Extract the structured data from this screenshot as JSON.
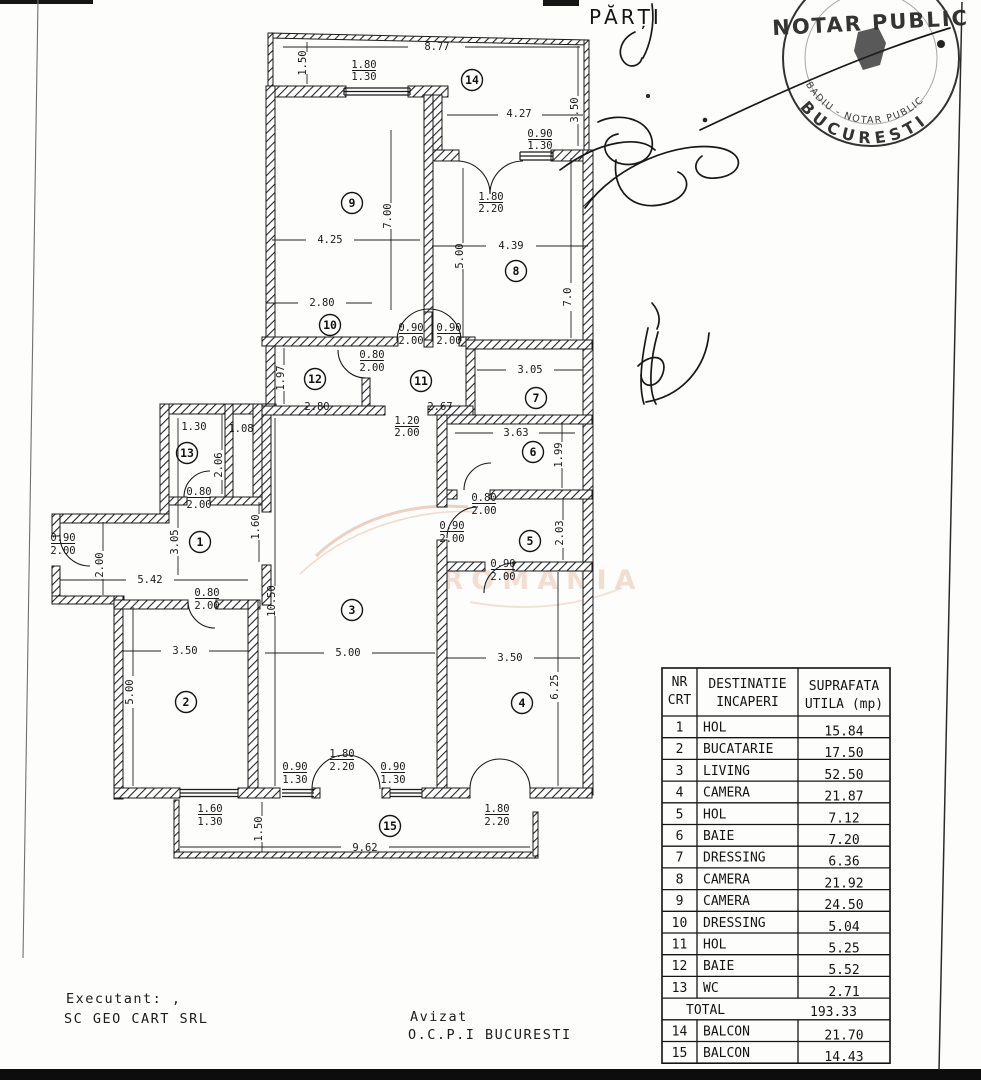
{
  "page": {
    "parti_label": "PĂRȚI"
  },
  "stamp": {
    "top_text": "NOTAR PUBLIC",
    "ring_text": "BADIU - NOTAR PUBLIC",
    "city_text": "BUCURESTI"
  },
  "watermark": {
    "text": "ROMANIA",
    "color": "#e2b39c"
  },
  "footer": {
    "executant_label": "Executant:  ,",
    "executant_name": "SC GEO CART SRL",
    "avizat_label": "Avizat",
    "avizat_name": "O.C.P.I  BUCURESTI"
  },
  "plan": {
    "room_markers": [
      {
        "n": "14",
        "x": 472,
        "y": 80
      },
      {
        "n": "9",
        "x": 352,
        "y": 203
      },
      {
        "n": "8",
        "x": 516,
        "y": 271
      },
      {
        "n": "10",
        "x": 330,
        "y": 325
      },
      {
        "n": "12",
        "x": 315,
        "y": 379
      },
      {
        "n": "11",
        "x": 421,
        "y": 381
      },
      {
        "n": "7",
        "x": 536,
        "y": 398
      },
      {
        "n": "6",
        "x": 533,
        "y": 452
      },
      {
        "n": "13",
        "x": 187,
        "y": 453
      },
      {
        "n": "1",
        "x": 200,
        "y": 542
      },
      {
        "n": "5",
        "x": 530,
        "y": 541
      },
      {
        "n": "3",
        "x": 352,
        "y": 610
      },
      {
        "n": "2",
        "x": 186,
        "y": 702
      },
      {
        "n": "4",
        "x": 522,
        "y": 703
      },
      {
        "n": "15",
        "x": 390,
        "y": 826
      }
    ],
    "dim_labels": [
      {
        "t": "8.77",
        "x": 437,
        "y": 50
      },
      {
        "t": "1.50",
        "x": 306,
        "y": 63,
        "r": -90
      },
      {
        "t": "1.80",
        "x": 364,
        "y": 68,
        "u": 1
      },
      {
        "t": "1.30",
        "x": 364,
        "y": 80
      },
      {
        "t": "4.27",
        "x": 519,
        "y": 117
      },
      {
        "t": "3.50",
        "x": 578,
        "y": 110,
        "r": -90
      },
      {
        "t": "0.90",
        "x": 540,
        "y": 137,
        "u": 1
      },
      {
        "t": "1.30",
        "x": 540,
        "y": 149
      },
      {
        "t": "1.80",
        "x": 491,
        "y": 200,
        "u": 1
      },
      {
        "t": "2.20",
        "x": 491,
        "y": 212
      },
      {
        "t": "7.00",
        "x": 391,
        "y": 216,
        "r": -90
      },
      {
        "t": "4.25",
        "x": 330,
        "y": 243
      },
      {
        "t": "4.39",
        "x": 511,
        "y": 249
      },
      {
        "t": "5.00",
        "x": 463,
        "y": 256,
        "r": -90
      },
      {
        "t": "7.0",
        "x": 571,
        "y": 297,
        "r": -90
      },
      {
        "t": "2.80",
        "x": 322,
        "y": 306
      },
      {
        "t": "0.90",
        "x": 411,
        "y": 331,
        "u": 1
      },
      {
        "t": "2.00",
        "x": 411,
        "y": 344
      },
      {
        "t": "0.90",
        "x": 449,
        "y": 331,
        "u": 1
      },
      {
        "t": "2.00",
        "x": 449,
        "y": 344
      },
      {
        "t": "0.80",
        "x": 372,
        "y": 358,
        "u": 1
      },
      {
        "t": "2.00",
        "x": 372,
        "y": 371
      },
      {
        "t": "1.97",
        "x": 284,
        "y": 378,
        "r": -90
      },
      {
        "t": "3.05",
        "x": 530,
        "y": 373
      },
      {
        "t": "2.80",
        "x": 317,
        "y": 410
      },
      {
        "t": "2.67",
        "x": 440,
        "y": 410
      },
      {
        "t": "1.20",
        "x": 407,
        "y": 424,
        "u": 1
      },
      {
        "t": "2.00",
        "x": 407,
        "y": 436
      },
      {
        "t": "3.63",
        "x": 516,
        "y": 436
      },
      {
        "t": "1.99",
        "x": 562,
        "y": 455,
        "r": -90
      },
      {
        "t": "1.30",
        "x": 194,
        "y": 430
      },
      {
        "t": "1.08",
        "x": 241,
        "y": 432
      },
      {
        "t": "2.06",
        "x": 222,
        "y": 465,
        "r": -90
      },
      {
        "t": "0.80",
        "x": 199,
        "y": 495,
        "u": 1
      },
      {
        "t": "2.00",
        "x": 199,
        "y": 508
      },
      {
        "t": "0.80",
        "x": 484,
        "y": 501,
        "u": 1
      },
      {
        "t": "2.00",
        "x": 484,
        "y": 514
      },
      {
        "t": "0.90",
        "x": 63,
        "y": 541,
        "u": 1
      },
      {
        "t": "2.00",
        "x": 63,
        "y": 554
      },
      {
        "t": "3.05",
        "x": 178,
        "y": 542,
        "r": -90
      },
      {
        "t": "1.60",
        "x": 259,
        "y": 527,
        "r": -90
      },
      {
        "t": "0.90",
        "x": 452,
        "y": 529,
        "u": 1
      },
      {
        "t": "2.00",
        "x": 452,
        "y": 542
      },
      {
        "t": "2.03",
        "x": 563,
        "y": 533,
        "r": -90
      },
      {
        "t": "2.00",
        "x": 103,
        "y": 565,
        "r": -90
      },
      {
        "t": "0.90",
        "x": 503,
        "y": 567,
        "u": 1
      },
      {
        "t": "2.00",
        "x": 503,
        "y": 580
      },
      {
        "t": "5.42",
        "x": 150,
        "y": 583
      },
      {
        "t": "10.50",
        "x": 275,
        "y": 601,
        "r": -90
      },
      {
        "t": "0.80",
        "x": 207,
        "y": 596,
        "u": 1
      },
      {
        "t": "2.00",
        "x": 207,
        "y": 609
      },
      {
        "t": "3.50",
        "x": 185,
        "y": 654
      },
      {
        "t": "5.00",
        "x": 348,
        "y": 656
      },
      {
        "t": "3.50",
        "x": 510,
        "y": 661
      },
      {
        "t": "6.25",
        "x": 558,
        "y": 687,
        "r": -90
      },
      {
        "t": "5.00",
        "x": 133,
        "y": 692,
        "r": -90
      },
      {
        "t": "0.90",
        "x": 295,
        "y": 770,
        "u": 1
      },
      {
        "t": "1.30",
        "x": 295,
        "y": 783
      },
      {
        "t": "1.80",
        "x": 342,
        "y": 757,
        "u": 1
      },
      {
        "t": "2.20",
        "x": 342,
        "y": 770
      },
      {
        "t": "0.90",
        "x": 393,
        "y": 770,
        "u": 1
      },
      {
        "t": "1.30",
        "x": 393,
        "y": 783
      },
      {
        "t": "1.60",
        "x": 210,
        "y": 812,
        "u": 1
      },
      {
        "t": "1.30",
        "x": 210,
        "y": 825
      },
      {
        "t": "1.80",
        "x": 497,
        "y": 812,
        "u": 1
      },
      {
        "t": "2.20",
        "x": 497,
        "y": 825
      },
      {
        "t": "1.50",
        "x": 262,
        "y": 829,
        "r": -90
      },
      {
        "t": "9.62",
        "x": 365,
        "y": 851
      }
    ]
  },
  "table": {
    "headers": {
      "col1a": "NR",
      "col1b": "CRT",
      "col2a": "DESTINATIE",
      "col2b": "INCAPERI",
      "col3a": "SUPRAFATA",
      "col3b": "UTILA (mp)"
    },
    "rows": [
      {
        "no": "1",
        "name": "HOL",
        "area": "15.84"
      },
      {
        "no": "2",
        "name": "BUCATARIE",
        "area": "17.50"
      },
      {
        "no": "3",
        "name": "LIVING",
        "area": "52.50"
      },
      {
        "no": "4",
        "name": "CAMERA",
        "area": "21.87"
      },
      {
        "no": "5",
        "name": "HOL",
        "area": "7.12"
      },
      {
        "no": "6",
        "name": "BAIE",
        "area": "7.20"
      },
      {
        "no": "7",
        "name": "DRESSING",
        "area": "6.36"
      },
      {
        "no": "8",
        "name": "CAMERA",
        "area": "21.92"
      },
      {
        "no": "9",
        "name": "CAMERA",
        "area": "24.50"
      },
      {
        "no": "10",
        "name": "DRESSING",
        "area": "5.04"
      },
      {
        "no": "11",
        "name": "HOL",
        "area": "5.25"
      },
      {
        "no": "12",
        "name": "BAIE",
        "area": "5.52"
      },
      {
        "no": "13",
        "name": "WC",
        "area": "2.71"
      }
    ],
    "total": {
      "label": "TOTAL",
      "value": "193.33"
    },
    "extra_rows": [
      {
        "no": "14",
        "name": "BALCON",
        "area": "21.70"
      },
      {
        "no": "15",
        "name": "BALCON",
        "area": "14.43"
      }
    ]
  }
}
